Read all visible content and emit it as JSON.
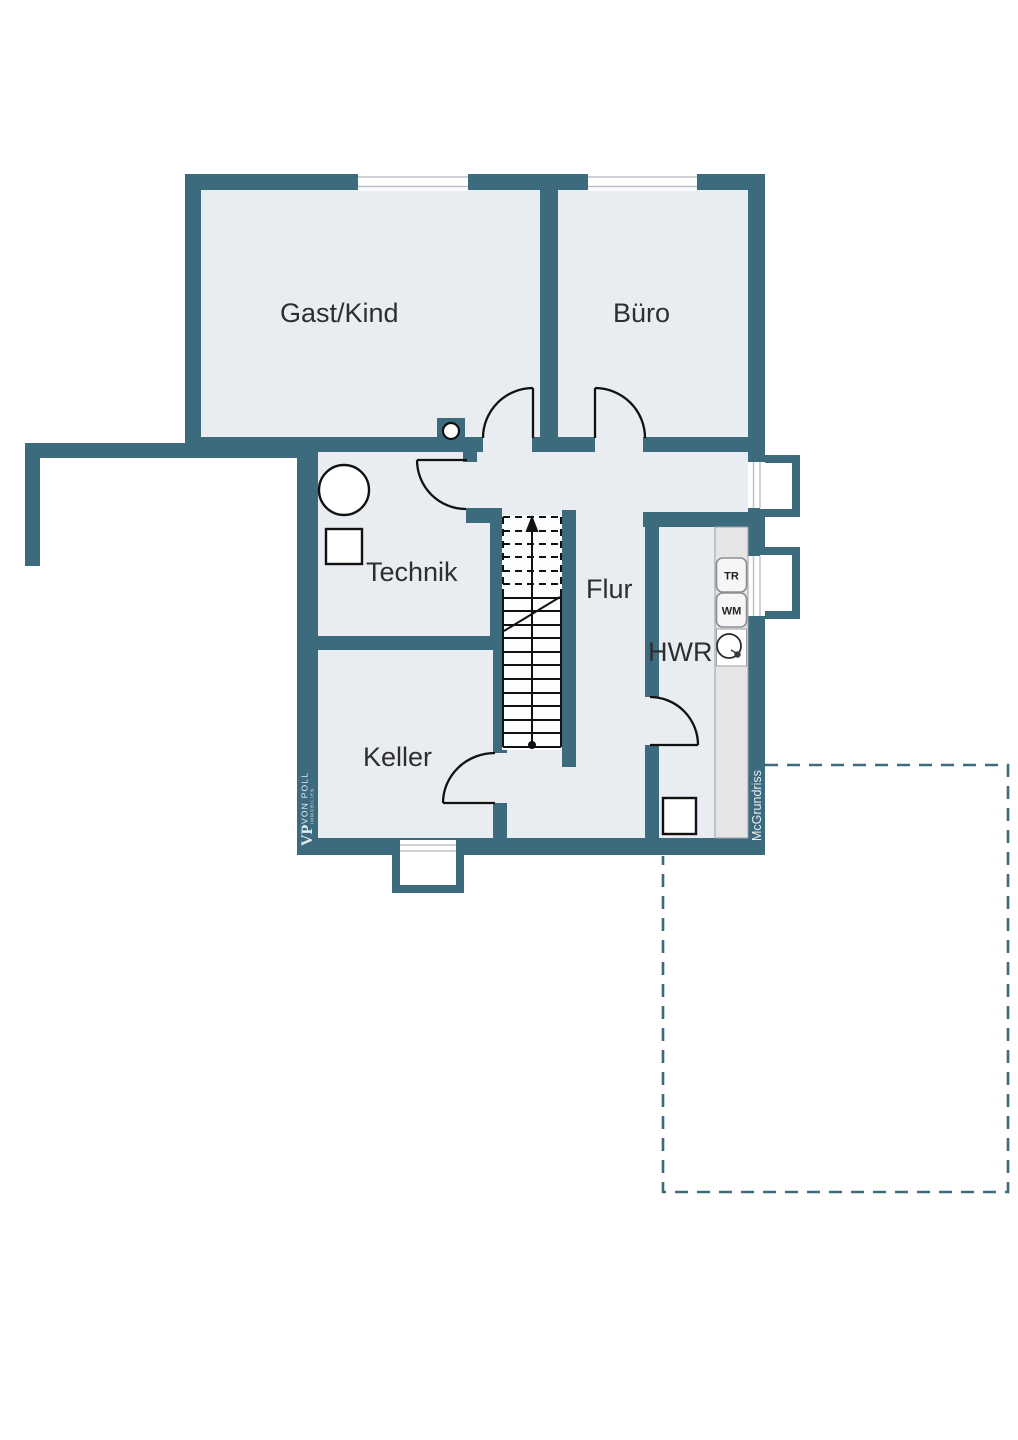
{
  "plan": {
    "type": "floor-plan-basement",
    "rooms": {
      "gast_kind": "Gast/Kind",
      "buero": "Büro",
      "technik": "Technik",
      "flur": "Flur",
      "hwr": "HWR",
      "keller": "Keller"
    },
    "appliances": {
      "dryer": "TR",
      "washer": "WM"
    }
  },
  "branding": {
    "monogram": "VP",
    "name": "VON POLL",
    "sub": "IMMOBILIEN",
    "watermark": "McGrundriss"
  },
  "colors": {
    "wall": "#3c6b7e",
    "room_fill": "#e9edf2",
    "stair_fill": "#fcfdfe",
    "appliance_strip": "#e5e5e5",
    "door_stroke": "#111111",
    "dashed_outline": "#3c6b7e",
    "label_text": "#2e2e2e"
  }
}
